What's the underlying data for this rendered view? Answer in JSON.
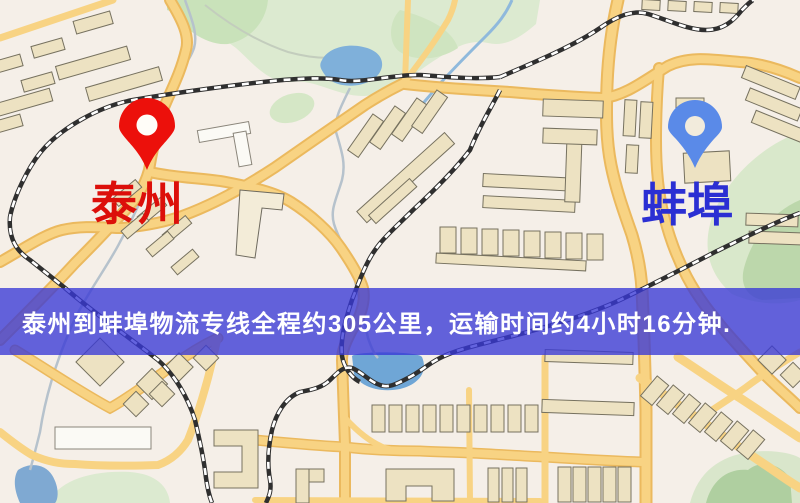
{
  "banner": {
    "text": "泰州到蚌埠物流专线全程约305公里，运输时间约4小时16分钟.",
    "background_color": "rgba(56,56,214,0.78)",
    "text_color": "#ffffff"
  },
  "route": {
    "origin": "泰州",
    "destination": "蚌埠",
    "distance_km": 305,
    "distance_text": "约305公里",
    "duration_text": "约4小时16分钟"
  },
  "markers": [
    {
      "id": "origin",
      "label": "泰州",
      "pin_style": "red-teardrop",
      "pin_color": "#ec100b",
      "label_color": "#dc0f0a"
    },
    {
      "id": "destination",
      "label": "蚌埠",
      "pin_style": "blue-teardrop",
      "pin_color": "#5a8ae8",
      "label_color": "#2b2fd3"
    }
  ],
  "map_palette": {
    "background": "#f5efe8",
    "road_fill": "#f8d383",
    "road_casing": "#ebb95e",
    "park_green": "#dcead0",
    "water_blue": "#7fb0da",
    "railway_dark": "#2f2f2f",
    "building_beige": "#ede2c2"
  }
}
